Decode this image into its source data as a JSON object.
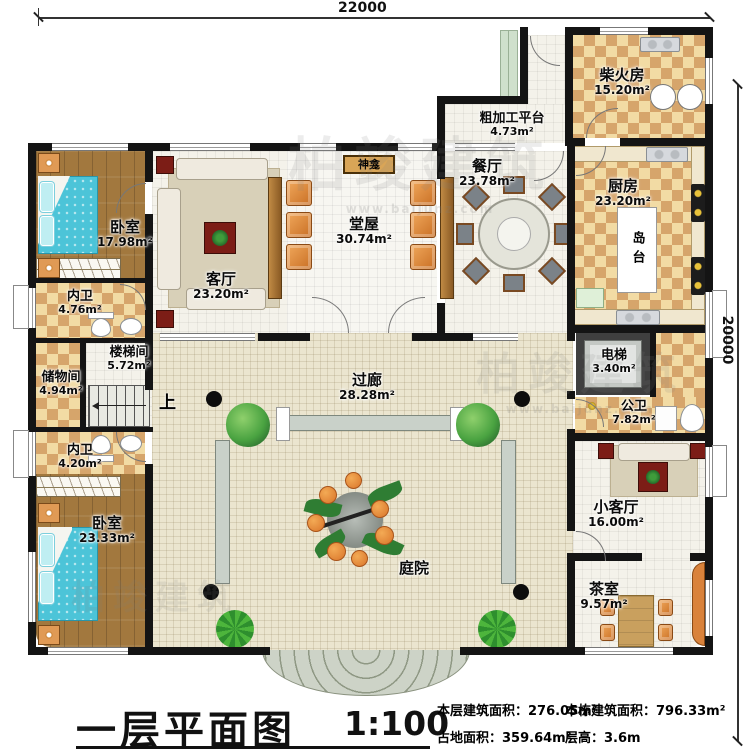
{
  "dimensions": {
    "top": "22000",
    "right": "20000"
  },
  "rooms": {
    "bedroom1": {
      "name": "卧室",
      "area": "17.98m²"
    },
    "bath1": {
      "name": "内卫",
      "area": "4.76m²"
    },
    "stairwell": {
      "name": "楼梯间",
      "area": "5.72m²"
    },
    "storage": {
      "name": "储物间",
      "area": "4.94m²"
    },
    "bath2": {
      "name": "内卫",
      "area": "4.20m²"
    },
    "bedroom2": {
      "name": "卧室",
      "area": "23.33m²"
    },
    "living_room": {
      "name": "客厅",
      "area": "23.20m²"
    },
    "main_hall": {
      "name": "堂屋",
      "area": "30.74m²"
    },
    "dining_room": {
      "name": "餐厅",
      "area": "23.78m²"
    },
    "prep_platform": {
      "name": "粗加工平台",
      "area": "4.73m²"
    },
    "firewood_room": {
      "name": "柴火房",
      "area": "15.20m²"
    },
    "kitchen": {
      "name": "厨房",
      "area": "23.20m²"
    },
    "elevator": {
      "name": "电梯",
      "area": "3.40m²"
    },
    "public_bath": {
      "name": "公卫",
      "area": "7.82m²"
    },
    "small_living": {
      "name": "小客厅",
      "area": "16.00m²"
    },
    "tea_room": {
      "name": "茶室",
      "area": "9.57m²"
    },
    "corridor": {
      "name": "过廊",
      "area": "28.28m²"
    },
    "courtyard": {
      "name": "庭院"
    }
  },
  "features": {
    "shrine": "神龛",
    "island": "岛台",
    "stairs_up": "上"
  },
  "title_block": {
    "title": "一层平面图",
    "scale": "1:100",
    "stats": [
      {
        "text": "本层建筑面积：276.05m²"
      },
      {
        "text": "本栋建筑面积：796.33m²"
      },
      {
        "text": "占地面积：359.64m²"
      },
      {
        "text": "层高：3.6m"
      }
    ]
  },
  "watermark": {
    "brand": "柏竣建筑",
    "url": "www.baijunz.com"
  }
}
